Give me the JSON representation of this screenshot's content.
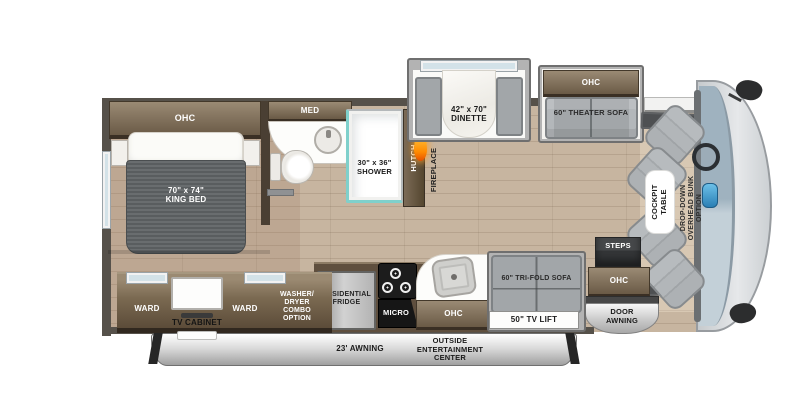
{
  "plan_title": "RV floor plan",
  "bedroom": {
    "ohc": "OHC",
    "bed": "70\" x 74\"\nKING BED"
  },
  "bathroom": {
    "med": "MED",
    "shower": "30\" x 36\"\nSHOWER"
  },
  "galley_wall": {
    "hutch": "HUTCH",
    "fireplace": "FIREPLACE"
  },
  "dinette": {
    "label": "42\" x 70\"\nDINETTE"
  },
  "theater": {
    "ohc": "OHC",
    "sofa": "60\" THEATER SOFA"
  },
  "cockpit": {
    "table": "COCKPIT\nTABLE",
    "bunk": "DROP-DOWN\nOVERHEAD BUNK\nOPTION"
  },
  "entry": {
    "steps": "STEPS",
    "ohc": "OHC",
    "door_awning": "DOOR\nAWNING"
  },
  "kitchen": {
    "fridge": "RESIDENTIAL\nFRIDGE",
    "micro": "MICRO",
    "ohc": "OHC"
  },
  "sofa_area": {
    "trifold": "60\" TRI-FOLD SOFA",
    "tv_lift": "50\" TV LIFT"
  },
  "storage": {
    "ward_left": "WARD",
    "tv_cabinet": "TV CABINET",
    "ward_right": "WARD",
    "washer_dryer": "WASHER/\nDRYER\nCOMBO\nOPTION"
  },
  "exterior": {
    "awning": "23' AWNING",
    "entertainment": "OUTSIDE\nENTERTAINMENT\nCENTER"
  },
  "colors": {
    "floor": "#c7b5a0",
    "cabinet_light": "#9a8a74",
    "cabinet_dark": "#5e4e3b",
    "slide_wall": "#b3b3b3",
    "sofa_gray": "#a2a6a9",
    "accent_teal": "#7fd0cb",
    "flame_orange": "#ff8a00",
    "awning_gray": "#c9c9c9",
    "windshield": "#a9bac5",
    "step_dark": "#3f4041"
  }
}
